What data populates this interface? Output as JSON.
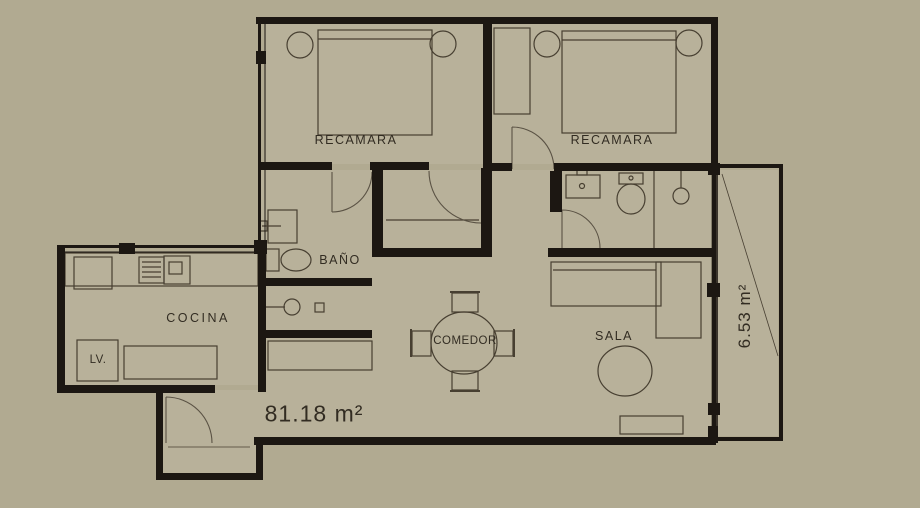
{
  "plan": {
    "rooms": [
      {
        "id": "bedroom-1",
        "label": "RECAMARA"
      },
      {
        "id": "bedroom-2",
        "label": "RECAMARA"
      },
      {
        "id": "bathroom",
        "label": "BAÑO"
      },
      {
        "id": "kitchen",
        "label": "COCINA"
      },
      {
        "id": "dining-room",
        "label": "COMEDOR"
      },
      {
        "id": "living-room",
        "label": "SALA"
      },
      {
        "id": "laundry",
        "label": "LV."
      }
    ],
    "areas": {
      "total": "81.18 m²",
      "balcony": "6.53 m²"
    },
    "colors": {
      "background": "#b1aa91",
      "interior": "#b8b19a",
      "wall": "#1c1712",
      "furniture_line": "#473f31",
      "door_line": "#5a5244",
      "text": "#322c22"
    }
  }
}
